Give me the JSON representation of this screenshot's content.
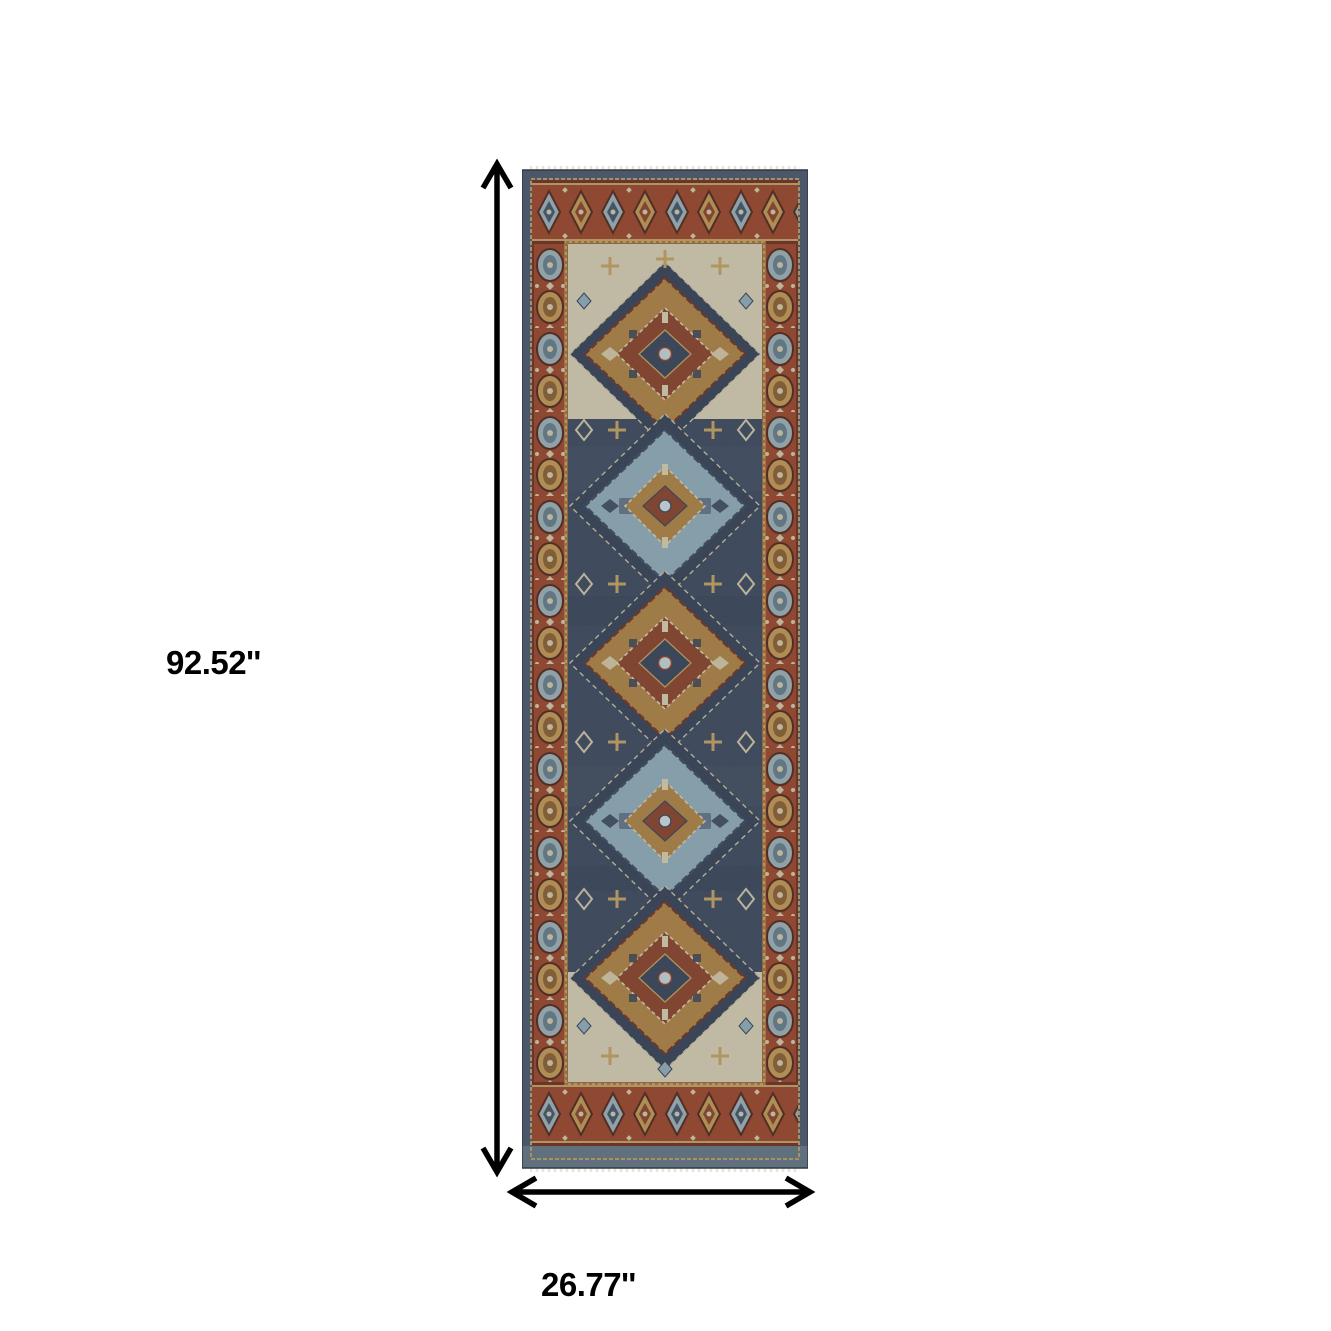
{
  "page": {
    "background": "#ffffff"
  },
  "annotations": {
    "height_label": "92.52''",
    "width_label": "26.77''"
  },
  "rug": {
    "palette": {
      "field_navy": "#33425a",
      "ground_navy": "#2b3a52",
      "border_rust": "#9c3f22",
      "maroon": "#6b2415",
      "gold": "#b2823c",
      "gold_light": "#c89a4e",
      "tan_guard": "#c9a55f",
      "steel_blue": "#8fb0c1",
      "steel_deep": "#5f7d8c",
      "ivory": "#ded5ba",
      "cream": "#d9cfae",
      "outer_band_navy": "#42536a",
      "outer_band_steel": "#5e7383",
      "fringe_cream": "#e9e1cb",
      "red_core": "#8a3b20"
    }
  }
}
